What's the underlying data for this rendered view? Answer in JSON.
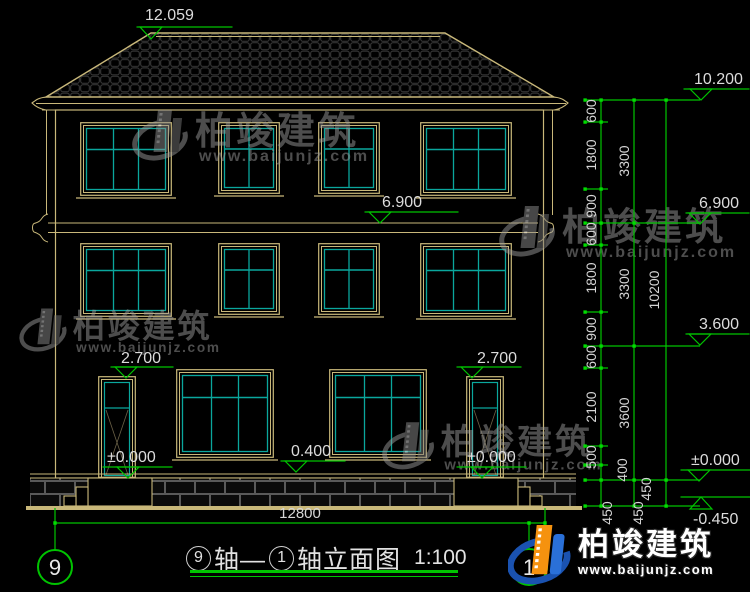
{
  "watermark": {
    "name": "柏竣建筑",
    "url": "www.baijunjz.com"
  },
  "logo": {
    "name": "柏竣建筑",
    "url": "www.baijunjz.com"
  },
  "title_block": {
    "bubble_left": "9",
    "axis_text_1": "轴—",
    "bubble_right": "1",
    "axis_text_2": "轴立面图",
    "scale": "1:100"
  },
  "axis_bubbles": {
    "left": "9",
    "right": "1"
  },
  "levels": {
    "ridge": "12.059",
    "eave": "10.200",
    "floor3_mid": "6.900",
    "floor3_right": "6.900",
    "floor2_right": "3.600",
    "door_left_top": "2.700",
    "door_right_top": "2.700",
    "window_sill": "0.400",
    "zero_left": "±0.000",
    "zero_right": "±0.000",
    "zero_chain": "±0.000",
    "ground": "-0.450"
  },
  "dimensions": {
    "vertical_detail": [
      "600",
      "1800",
      "900",
      "600",
      "1800",
      "900",
      "600",
      "2100",
      "500",
      "400",
      "450"
    ],
    "vertical_floors": [
      "3300",
      "3300",
      "3600",
      "450"
    ],
    "vertical_total": [
      "10200",
      "450"
    ],
    "horizontal_total": "12800"
  },
  "colors": {
    "dimension_green": "#00c400",
    "outline_tan": "#c9b87a",
    "window_teal": "#0aa79d",
    "text_white": "#dcdcdc",
    "logo_blue": "#1a52b0",
    "logo_orange": "#f5920f"
  }
}
